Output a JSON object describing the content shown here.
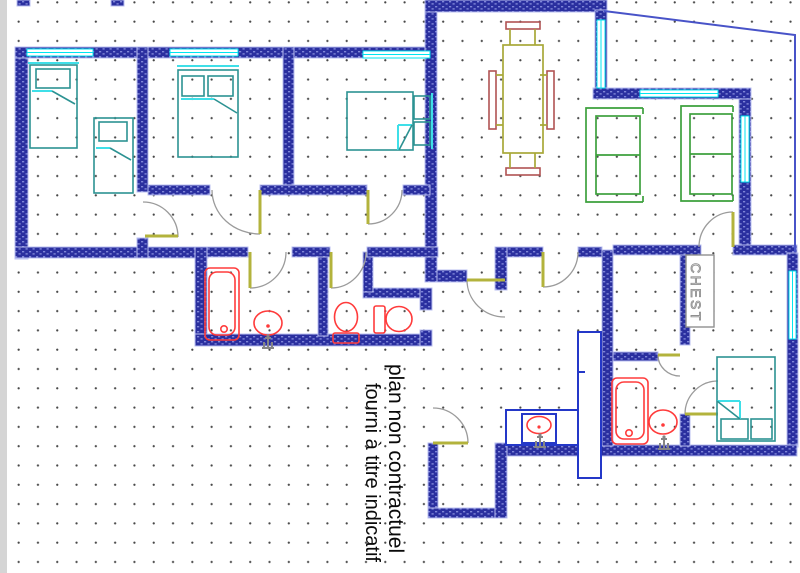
{
  "disclaimer": {
    "line1": "plan non contractuel",
    "line2": "fourni à titre indicatif"
  },
  "furniture": {
    "chest_label": "CHEST"
  },
  "palette": {
    "wall_navy": "#2a2f9f",
    "wall_speckle": "#7f86d8",
    "window_aqua": "#00e6f0",
    "bed_teal": "#2c9292",
    "bed_accent": "#3fdfe8",
    "sofa_green": "#3da03d",
    "table_olive": "#a8a838",
    "chair_red": "#b05353",
    "fixture_red": "#ff3b3b",
    "cabinet_blue": "#2438c8",
    "door_leaf_olive": "#b3b33c",
    "door_arc_gray": "#9b9b9b",
    "chest_gray": "#909090",
    "balcony_blue": "#4853c8",
    "grid_dot": "#474747",
    "text": "#0a0a0a"
  }
}
